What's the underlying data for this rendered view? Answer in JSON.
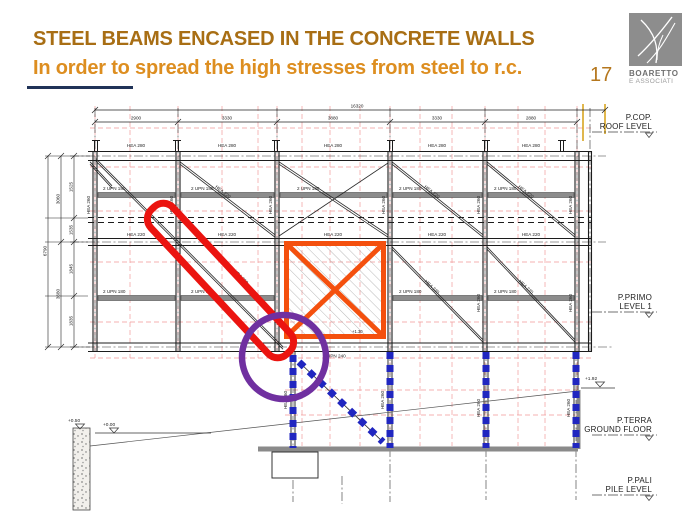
{
  "slide": {
    "title_line1": "STEEL BEAMS ENCASED IN THE CONCRETE WALLS",
    "title_line2": "In order to spread the high stresses from steel to r.c.",
    "page_number": "17",
    "logo": {
      "name": "BOARETTO",
      "subname": "E ASSOCIATI"
    },
    "colors": {
      "title_brown": "#A86E14",
      "title_orange": "#DD8E20",
      "accent_navy": "#203358",
      "highlight_red": "#EB1410",
      "highlight_orange": "#F4500E",
      "highlight_purple": "#7030A0",
      "encased_steel_blue": "#2026C0",
      "grid_red": "#EE8888",
      "grid_gold": "#D9A521"
    }
  },
  "drawing": {
    "dims": {
      "top_segments": [
        "2900",
        "3330",
        "3880",
        "3330",
        "2880"
      ],
      "top_total": "16320",
      "left_inner": [
        "1525",
        "1535",
        "1845",
        "1835"
      ],
      "left_mid": [
        "3060",
        "3680"
      ],
      "left_total": "6790"
    },
    "members": {
      "top_chord": "HEA 280",
      "mid_chord": "HEA 220",
      "floor_beam": "2 UPN 180",
      "bottom_chord": "UPN 240",
      "column": "HEA 260",
      "diagonal": "HEA 220"
    },
    "levels": [
      {
        "name": "P.COP.",
        "desc": "ROOF LEVEL"
      },
      {
        "name": "P.PRIMO",
        "desc": "LEVEL 1"
      },
      {
        "name": "P.TERRA",
        "desc": "GROUND FLOOR"
      },
      {
        "name": "P.PALI",
        "desc": "PILE LEVEL"
      }
    ],
    "elevations": {
      "right_ground": "+1.92",
      "wall_top": "+0.50",
      "left_ground": "+0.00",
      "panel_node": "+1.30"
    }
  }
}
